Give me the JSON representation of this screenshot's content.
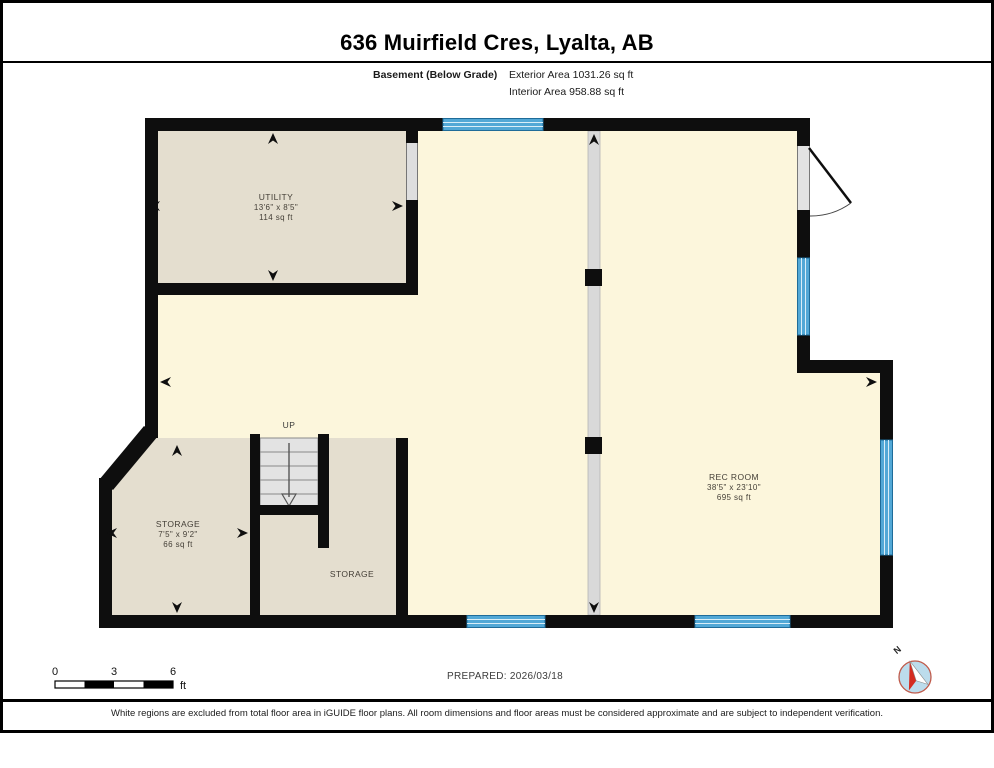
{
  "page": {
    "title": "636 Muirfield Cres, Lyalta, AB",
    "floor_label": "Basement (Below Grade)",
    "exterior_area": "Exterior Area 1031.26 sq ft",
    "interior_area": "Interior Area 958.88 sq ft",
    "prepared": "PREPARED: 2026/03/18",
    "disclaimer": "White regions are excluded from total floor area in iGUIDE floor plans. All room dimensions and floor areas must be considered approximate and are subject to independent verification."
  },
  "rooms": {
    "utility": {
      "name": "UTILITY",
      "dims": "13'6\" x 8'5\"",
      "area": "114 sq ft"
    },
    "storage": {
      "name": "STORAGE",
      "dims": "7'5\" x 9'2\"",
      "area": "66 sq ft"
    },
    "storage2": {
      "name": "STORAGE"
    },
    "rec_room": {
      "name": "REC ROOM",
      "dims": "38'5\" x 23'10\"",
      "area": "695 sq ft"
    }
  },
  "stairs": {
    "direction_label": "UP"
  },
  "scale_bar": {
    "ticks": [
      "0",
      "3",
      "6"
    ],
    "unit": "ft"
  },
  "compass": {
    "north_label": "N"
  },
  "colors": {
    "wall": "#0e0e0e",
    "open_area_fill": "#FCF6DC",
    "room_fill": "#E4DECF",
    "window_blue": "#52A8D6",
    "opening_gray": "#DEDEDE",
    "stairs_gray": "#E3E3E3"
  }
}
